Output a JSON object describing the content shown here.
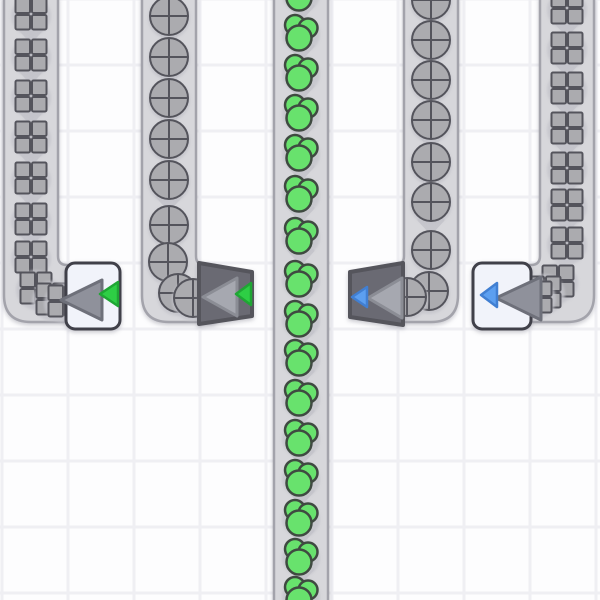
{
  "scene": {
    "grid": {
      "cell_color": "#fdfdfe",
      "line_color": "#efeff3",
      "size": 66,
      "x_start": 2,
      "y_start": -1,
      "line_width": 3
    },
    "palette": {
      "belt_fill": "#d7d7db",
      "belt_border": "#a3a3ab",
      "belt_arrow": "#c6c6cc",
      "item_blob": "#c4c4cb",
      "stone_fill": "#ababaf",
      "stone_stroke": "#54545c",
      "berry_fill": "#68e26d",
      "berry_stroke": "#3f4a41",
      "device_light_fill": "#f1f3fa",
      "device_light_border": "#40404a",
      "device_dark_fill": "#6b6b73",
      "device_dark_border": "#54545c",
      "big_arrow_on_light_fill": "#8f919b",
      "big_arrow_on_light_stroke": "#6e707a",
      "big_arrow_on_dark_fill": "#a6a8b0",
      "big_arrow_on_dark_stroke": "#8b8d95",
      "green_arrow_fill": "#2ece45",
      "green_arrow_stroke": "#1fa634",
      "blue_arrow_fill": "#5c9ff0",
      "blue_arrow_stroke": "#417fd2",
      "shadow": "#8a8a96"
    },
    "belts": [
      {
        "name": "conveyor-belt-1",
        "item": "stone-square",
        "center_x": 31,
        "path": "M 4,-2 L 4,295 Q 4,322 31,322 L 76,322 L 76,265 L 67,265 Q 58,265 58,256 L 58,-2 Z",
        "lane_y": [
          14,
          55,
          96,
          137,
          178,
          219,
          257
        ],
        "curve_items": [
          [
            36,
            288
          ],
          [
            52,
            299
          ],
          [
            64,
            301
          ]
        ]
      },
      {
        "name": "conveyor-belt-2",
        "item": "stone-circle",
        "center_x": 169,
        "path": "M 142,-2 L 142,295 Q 142,322 169,322 L 214,322 L 214,265 L 205,265 Q 196,265 196,256 L 196,-2 Z",
        "lane_y": [
          16,
          57,
          98,
          139,
          180,
          225
        ],
        "curve_items": [
          [
            168,
            262
          ],
          [
            178,
            293
          ],
          [
            193,
            298
          ]
        ]
      },
      {
        "name": "conveyor-belt-3",
        "item": "berry-cluster",
        "center_x": 301,
        "path": "M 274,-4 L 274,604 L 328,604 L 328,-4 Z",
        "lane_y": [
          -8,
          32,
          72,
          112,
          152,
          193,
          235,
          278,
          318,
          357,
          397,
          437,
          477,
          517,
          556,
          594
        ],
        "curve_items": []
      },
      {
        "name": "conveyor-belt-4",
        "item": "stone-circle",
        "center_x": 431,
        "path": "M 458,-2 L 458,295 Q 458,322 431,322 L 388,322 L 388,265 L 395,265 Q 404,265 404,256 L 404,-2 Z",
        "lane_y": [
          0,
          40,
          80,
          120,
          162,
          202,
          250
        ],
        "curve_items": [
          [
            429,
            291
          ],
          [
            407,
            297
          ]
        ]
      },
      {
        "name": "conveyor-belt-5",
        "item": "stone-square",
        "center_x": 567,
        "path": "M 594,-2 L 594,295 Q 594,322 567,322 L 522,322 L 522,265 L 531,265 Q 540,265 540,256 L 540,-2 Z",
        "lane_y": [
          8,
          48,
          88,
          128,
          168,
          205,
          243
        ],
        "curve_items": [
          [
            558,
            281
          ],
          [
            545,
            292
          ],
          [
            536,
            297
          ]
        ]
      }
    ],
    "devices": [
      {
        "name": "tunnel-exit-left",
        "style": "light",
        "shape": {
          "kind": "rect",
          "x": 66,
          "y": 263,
          "w": 54,
          "h": 66,
          "r": 9
        },
        "big_arrow": {
          "tip": [
            61,
            300
          ],
          "base_x": 102,
          "y1": 280,
          "y2": 320
        },
        "small_arrow": {
          "color": "green",
          "tip": [
            100,
            294
          ],
          "base_x": 118,
          "y1": 282,
          "y2": 306
        }
      },
      {
        "name": "tunnel-exit-mid",
        "style": "dark",
        "shape": {
          "kind": "poly",
          "points": [
            [
              199,
              263
            ],
            [
              252,
              272
            ],
            [
              252,
              316
            ],
            [
              199,
              324
            ]
          ]
        },
        "big_arrow": {
          "tip": [
            203,
            297
          ],
          "base_x": 237,
          "y1": 278,
          "y2": 316
        },
        "small_arrow": {
          "color": "green",
          "tip": [
            236,
            294
          ],
          "base_x": 251,
          "y1": 283,
          "y2": 305
        }
      },
      {
        "name": "tunnel-entrance-mid",
        "style": "dark",
        "shape": {
          "kind": "poly",
          "points": [
            [
              350,
              272
            ],
            [
              403,
              263
            ],
            [
              403,
              325
            ],
            [
              350,
              317
            ]
          ]
        },
        "big_arrow": {
          "tip": [
            368,
            298
          ],
          "base_x": 402,
          "y1": 278,
          "y2": 318
        },
        "small_arrow": {
          "color": "blue",
          "tip": [
            352,
            297
          ],
          "base_x": 367,
          "y1": 287,
          "y2": 307
        }
      },
      {
        "name": "tunnel-entrance-right",
        "style": "light",
        "shape": {
          "kind": "rect",
          "x": 473,
          "y": 263,
          "w": 58,
          "h": 66,
          "r": 9
        },
        "big_arrow": {
          "tip": [
            496,
            298
          ],
          "base_x": 541,
          "y1": 277,
          "y2": 320
        },
        "small_arrow": {
          "color": "blue",
          "tip": [
            481,
            295
          ],
          "base_x": 497,
          "y1": 283,
          "y2": 307
        }
      }
    ]
  }
}
